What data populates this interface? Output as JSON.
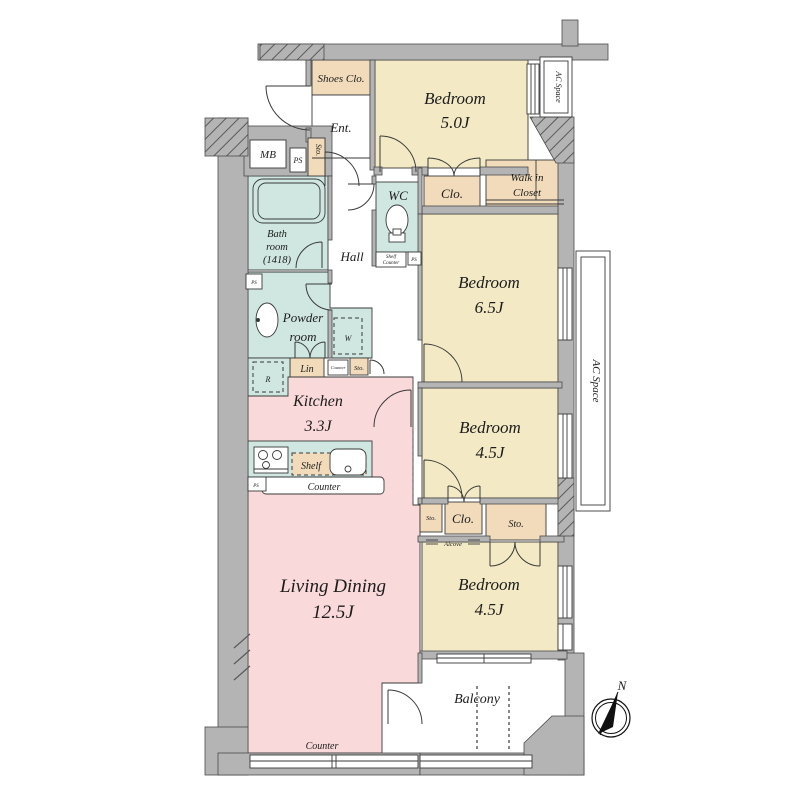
{
  "labels": {
    "shoes_clo": "Shoes Clo.",
    "ent": "Ent.",
    "bedroom": "Bedroom",
    "bedroom_top_size": "5.0J",
    "bedroom_65_size": "6.5J",
    "bedroom_mid_size": "4.5J",
    "bedroom_bottom_size": "4.5J",
    "ac_space": "AC Space",
    "mb": "MB",
    "ps": "PS",
    "sto": "Sto.",
    "clo": "Clo.",
    "walk_in_1": "Walk in",
    "walk_in_2": "Closet",
    "wc": "WC",
    "shelf_counter_1": "Shelf",
    "shelf_counter_2": "Counter",
    "bath_1": "Bath",
    "bath_2": "room",
    "bath_3": "(1418)",
    "hall": "Hall",
    "powder_1": "Powder",
    "powder_2": "room",
    "washer": "W",
    "lin": "Lin",
    "counter": "Counter",
    "fridge": "R",
    "kitchen": "Kitchen",
    "kitchen_size": "3.3J",
    "shelf": "Shelf",
    "alcove": "Alcove",
    "living_dining": "Living Dining",
    "living_dining_size": "12.5J",
    "balcony": "Balcony",
    "north": "N"
  },
  "colors": {
    "bedroom": "#f3eac5",
    "closet": "#f1dbbb",
    "wet": "#cfe7e0",
    "living": "#f9d9d9",
    "wall": "#b4b4b4",
    "white": "#ffffff"
  }
}
